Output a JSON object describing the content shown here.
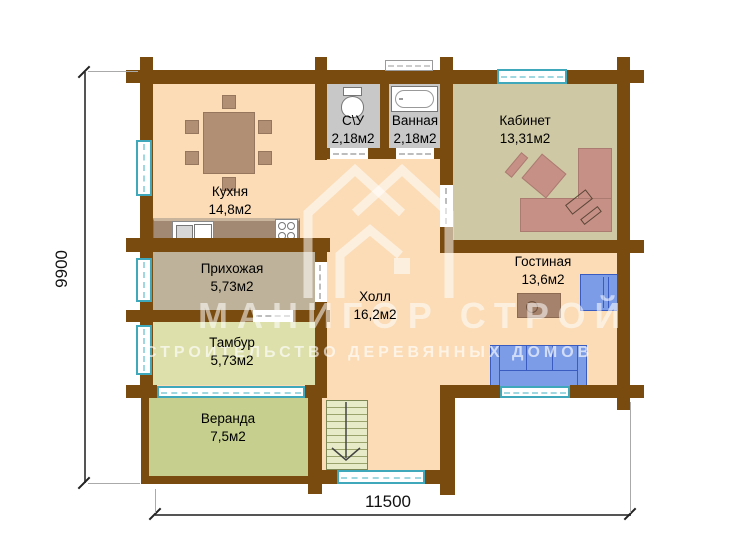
{
  "watermark": {
    "brand": "МАНИГОР СТРОЙ",
    "tagline": "СТРОИТЕЛЬСТВО ДЕРЕВЯННЫХ ДОМОВ"
  },
  "dimensions": {
    "height": "9900",
    "width": "11500"
  },
  "rooms": {
    "kitchen": {
      "name": "Кухня",
      "area": "14,8м2"
    },
    "wc": {
      "name": "С\\У",
      "area": "2,18м2"
    },
    "bathroom": {
      "name": "Ванная",
      "area": "2,18м2"
    },
    "office": {
      "name": "Кабинет",
      "area": "13,31м2"
    },
    "hallway": {
      "name": "Прихожая",
      "area": "5,73м2"
    },
    "hall": {
      "name": "Холл",
      "area": "16,2м2"
    },
    "living_room": {
      "name": "Гостиная",
      "area": "13,6м2"
    },
    "tambour": {
      "name": "Тамбур",
      "area": "5,73м2"
    },
    "veranda": {
      "name": "Веранда",
      "area": "7,5м2"
    }
  },
  "colors": {
    "wall": "#7a4b0e",
    "floor_main": "#fbdcb6",
    "floor_wet": "#c8c8c8",
    "floor_office": "#cfc8a4",
    "floor_hallway": "#beb29a",
    "floor_tambour": "#dde0aa",
    "floor_veranda": "#c6cf8d",
    "window_frame": "#3fa8ba",
    "sofa_blue": "#7c9ce8",
    "desk_rose": "#c69086",
    "furniture_wood": "#b08f74",
    "watermark_white": "rgba(255,255,255,0.55)"
  }
}
